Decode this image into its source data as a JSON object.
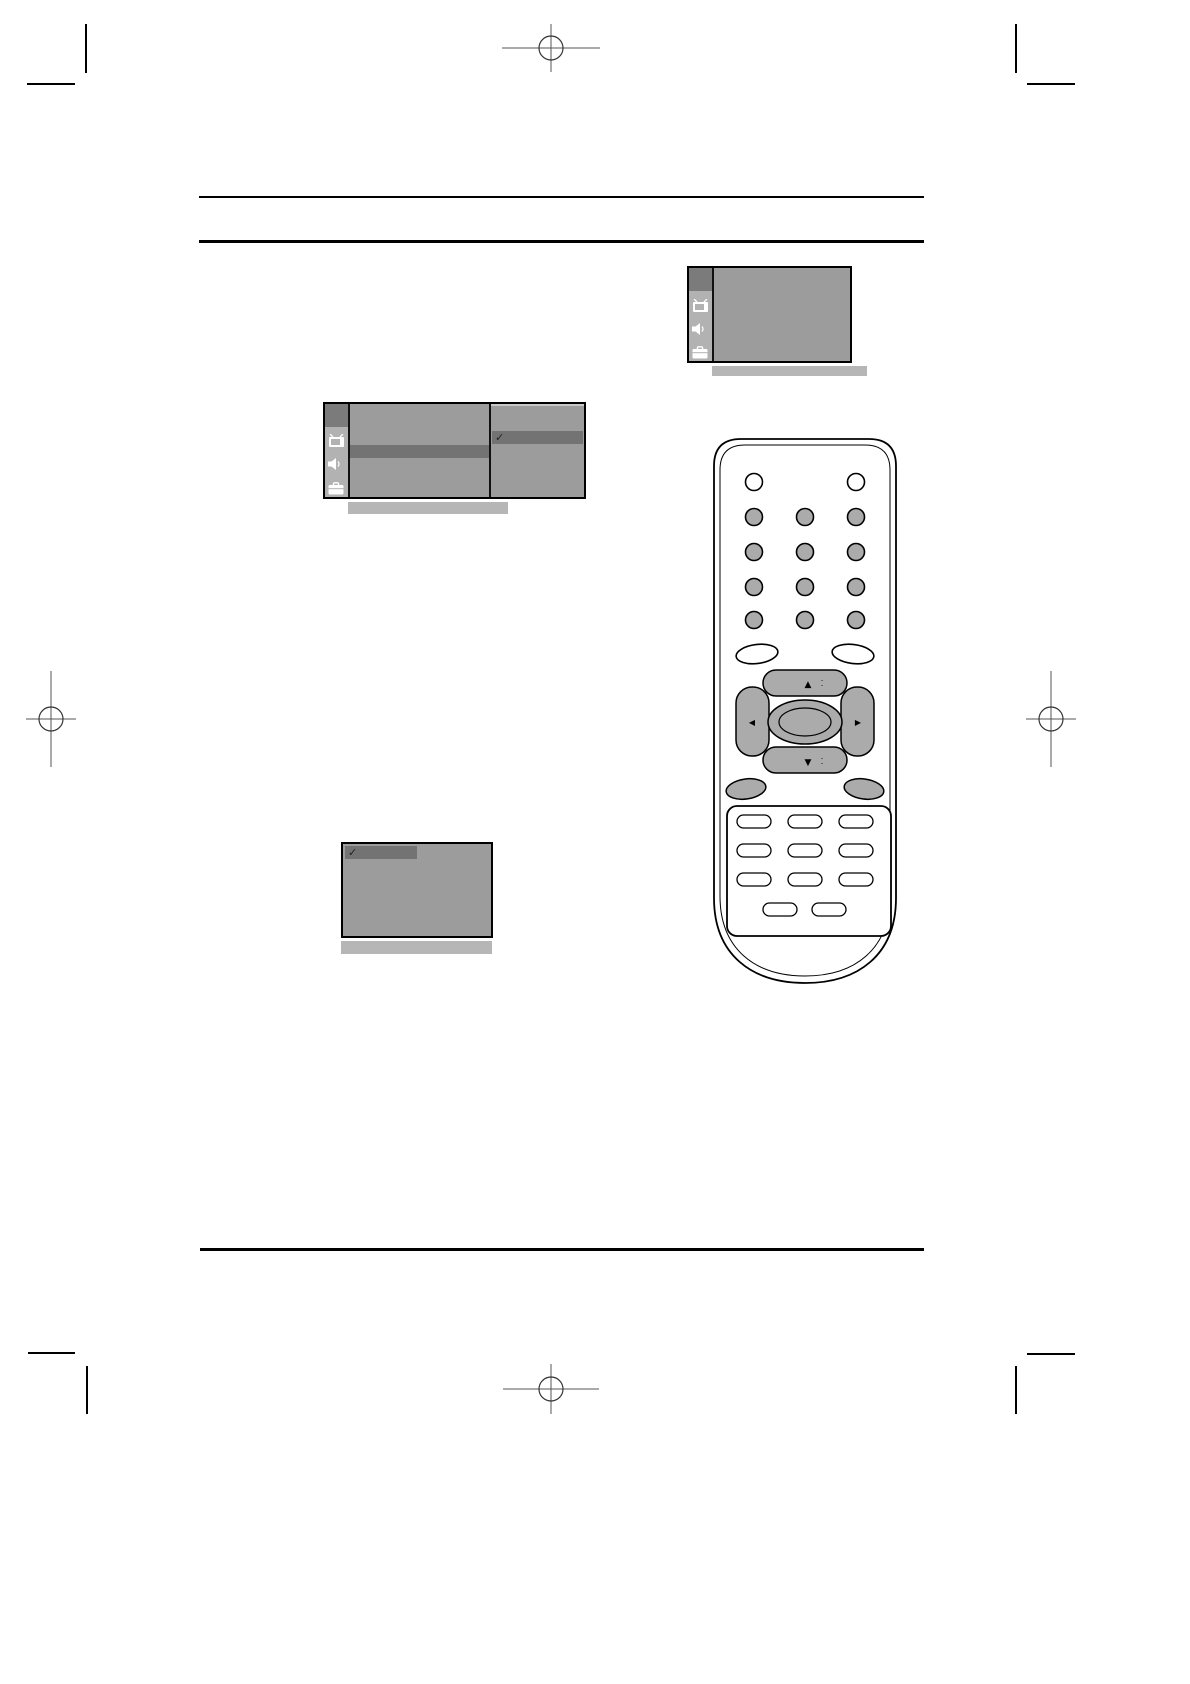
{
  "page": {
    "width_px": 1190,
    "height_px": 1684,
    "background": "#ffffff"
  },
  "colors": {
    "rule": "#000000",
    "crop_mark": "#000000",
    "registration_mark": "#555555",
    "osd_panel": "#9c9c9c",
    "osd_sidebar": "#b2b2b2",
    "osd_active_tab": "#7b7b7b",
    "osd_highlight_row": "#737373",
    "osd_caption_bar": "#b6b6b6",
    "osd_border": "#000000",
    "osd_icon_color": "#ffffff",
    "remote_body": "#ffffff",
    "remote_button_fill": "#ababab",
    "remote_outline": "#000000"
  },
  "osd_menus": {
    "sidebar_icons": [
      "tv-icon",
      "speaker-icon",
      "briefcase-icon"
    ],
    "submenu_checkmark": "✓",
    "option_checkmark": "✓"
  },
  "remote": {
    "nav_up_arrow": "▲",
    "nav_up_dots": "⁚",
    "nav_down_arrow": "▼",
    "nav_down_dots": "⁚",
    "nav_left_arrow": "◀",
    "nav_right_arrow": "▶"
  }
}
